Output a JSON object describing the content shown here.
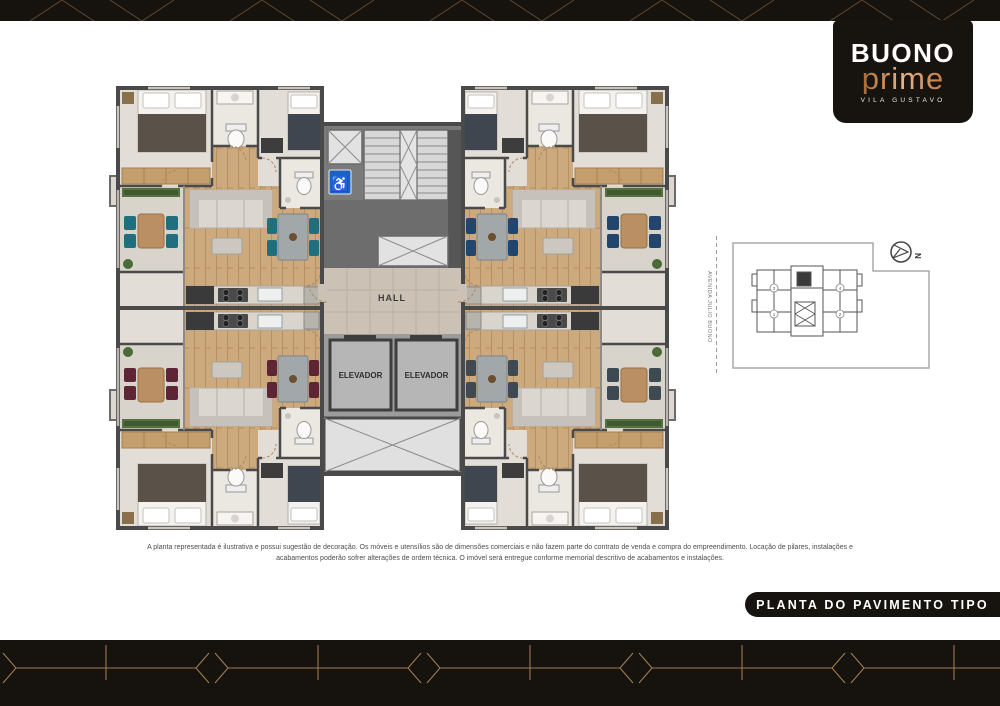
{
  "brand": {
    "line1": "BUONO",
    "line2": "prime",
    "subtitle": "VILA GUSTAVO"
  },
  "plan": {
    "hall": "HALL",
    "elevator1": "ELEVADOR",
    "elevator2": "ELEVADOR"
  },
  "keyplan": {
    "north": "N",
    "street": "AVENIDA JULIO BUONO",
    "units": {
      "tl": "3",
      "bl": "1",
      "tr": "4",
      "br": "2"
    }
  },
  "disclaimer": {
    "line1": "A planta representada é ilustrativa e possui sugestão de decoração. Os móveis e utensílios são de dimensões comerciais e não fazem parte do contrato de venda e compra do empreendimento. Locação de pilares, instalações e",
    "line2": "acabamentos poderão sofrer alterações de ordem técnica. O imóvel será entregue conforme memorial descritivo de acabamentos e instalações."
  },
  "footer": {
    "title": "PLANTA DO PAVIMENTO TIPO"
  },
  "colors": {
    "band": "#16120e",
    "deco_gold": "#a57e55",
    "accent_tl": "#1f6f7f",
    "accent_tr": "#24456b",
    "accent_bl": "#5d2535",
    "accent_br": "#3e4a52",
    "accessibility_blue": "#1a63c4",
    "logo_gradient_from": "#a96a33",
    "logo_gradient_to": "#eab388"
  }
}
